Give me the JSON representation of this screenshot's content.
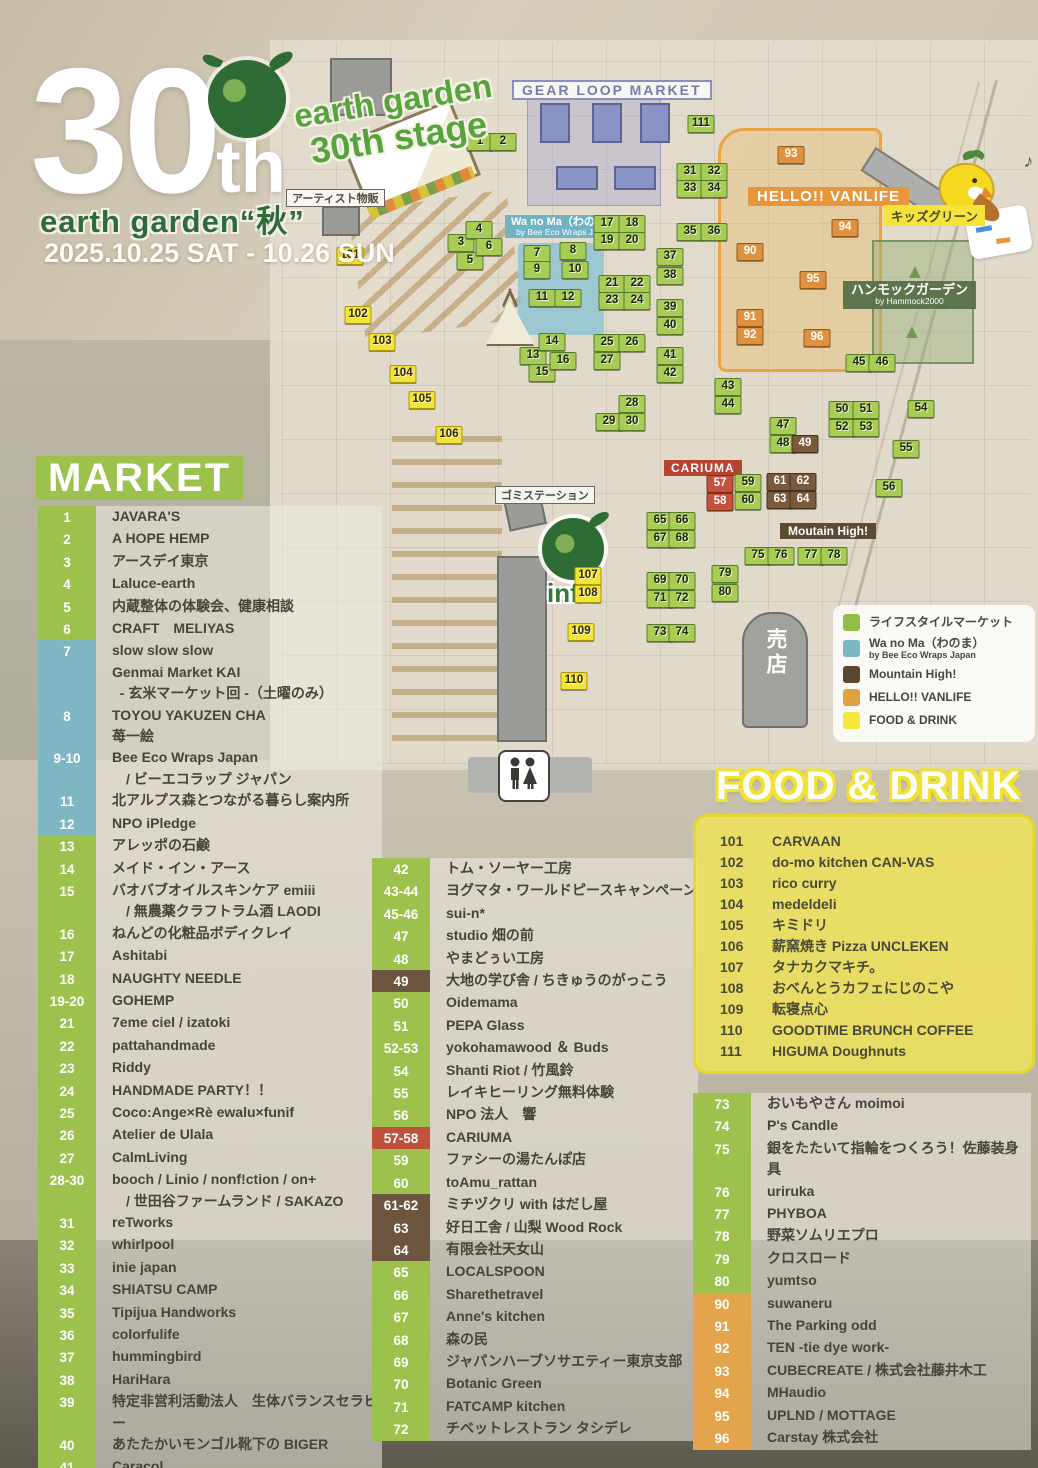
{
  "header": {
    "number": "30",
    "suffix": "th",
    "event_title": "earth garden“秋”",
    "dates": "2025.10.25 SAT - 10.26 SUN",
    "stage_line1": "earth garden",
    "stage_line2": "30th stage"
  },
  "map": {
    "labels": {
      "gear_loop": "GEAR LOOP MARKET",
      "artist_goods": "アーティスト物販",
      "wanoma_title": "Wa no Ma（わのま）",
      "wanoma_sub": "by Bee Eco Wraps Japan",
      "vanlife": "HELLO!! VANLIFE",
      "kids_green": "キッズグリーン",
      "hammock_title": "ハンモックガーデン",
      "hammock_sub": "by Hammock2000",
      "cariuma": "CARIUMA",
      "trash_station": "ゴミステーション",
      "mountain_high": "Moutain High!",
      "info": "info",
      "shop": "売店",
      "note": "♪"
    },
    "markers": [
      {
        "n": "1",
        "x": 480,
        "y": 142,
        "c": "g"
      },
      {
        "n": "2",
        "x": 503,
        "y": 142,
        "c": "g"
      },
      {
        "n": "3",
        "x": 461,
        "y": 243,
        "c": "g"
      },
      {
        "n": "4",
        "x": 479,
        "y": 230,
        "c": "g"
      },
      {
        "n": "5",
        "x": 470,
        "y": 261,
        "c": "g"
      },
      {
        "n": "6",
        "x": 489,
        "y": 247,
        "c": "g"
      },
      {
        "n": "7",
        "x": 537,
        "y": 254,
        "c": "g"
      },
      {
        "n": "8",
        "x": 573,
        "y": 251,
        "c": "g"
      },
      {
        "n": "9",
        "x": 537,
        "y": 270,
        "c": "g"
      },
      {
        "n": "10",
        "x": 575,
        "y": 270,
        "c": "g"
      },
      {
        "n": "11",
        "x": 542,
        "y": 298,
        "c": "g"
      },
      {
        "n": "12",
        "x": 568,
        "y": 298,
        "c": "g"
      },
      {
        "n": "13",
        "x": 533,
        "y": 356,
        "c": "g"
      },
      {
        "n": "14",
        "x": 552,
        "y": 342,
        "c": "g"
      },
      {
        "n": "15",
        "x": 542,
        "y": 373,
        "c": "g"
      },
      {
        "n": "16",
        "x": 563,
        "y": 361,
        "c": "g"
      },
      {
        "n": "17",
        "x": 607,
        "y": 224,
        "c": "g"
      },
      {
        "n": "18",
        "x": 632,
        "y": 224,
        "c": "g"
      },
      {
        "n": "19",
        "x": 607,
        "y": 241,
        "c": "g"
      },
      {
        "n": "20",
        "x": 632,
        "y": 241,
        "c": "g"
      },
      {
        "n": "21",
        "x": 612,
        "y": 284,
        "c": "g"
      },
      {
        "n": "22",
        "x": 637,
        "y": 284,
        "c": "g"
      },
      {
        "n": "23",
        "x": 612,
        "y": 301,
        "c": "g"
      },
      {
        "n": "24",
        "x": 637,
        "y": 301,
        "c": "g"
      },
      {
        "n": "25",
        "x": 607,
        "y": 343,
        "c": "g"
      },
      {
        "n": "26",
        "x": 632,
        "y": 343,
        "c": "g"
      },
      {
        "n": "27",
        "x": 607,
        "y": 361,
        "c": "g"
      },
      {
        "n": "28",
        "x": 632,
        "y": 404,
        "c": "g"
      },
      {
        "n": "29",
        "x": 609,
        "y": 422,
        "c": "g"
      },
      {
        "n": "30",
        "x": 632,
        "y": 422,
        "c": "g"
      },
      {
        "n": "31",
        "x": 690,
        "y": 172,
        "c": "g"
      },
      {
        "n": "32",
        "x": 714,
        "y": 172,
        "c": "g"
      },
      {
        "n": "33",
        "x": 690,
        "y": 189,
        "c": "g"
      },
      {
        "n": "34",
        "x": 714,
        "y": 189,
        "c": "g"
      },
      {
        "n": "35",
        "x": 690,
        "y": 232,
        "c": "g"
      },
      {
        "n": "36",
        "x": 714,
        "y": 232,
        "c": "g"
      },
      {
        "n": "37",
        "x": 670,
        "y": 257,
        "c": "g"
      },
      {
        "n": "38",
        "x": 670,
        "y": 276,
        "c": "g"
      },
      {
        "n": "39",
        "x": 670,
        "y": 308,
        "c": "g"
      },
      {
        "n": "40",
        "x": 670,
        "y": 326,
        "c": "g"
      },
      {
        "n": "41",
        "x": 670,
        "y": 356,
        "c": "g"
      },
      {
        "n": "42",
        "x": 670,
        "y": 374,
        "c": "g"
      },
      {
        "n": "43",
        "x": 728,
        "y": 387,
        "c": "g"
      },
      {
        "n": "44",
        "x": 728,
        "y": 405,
        "c": "g"
      },
      {
        "n": "45",
        "x": 859,
        "y": 363,
        "c": "g"
      },
      {
        "n": "46",
        "x": 882,
        "y": 363,
        "c": "g"
      },
      {
        "n": "47",
        "x": 783,
        "y": 426,
        "c": "g"
      },
      {
        "n": "48",
        "x": 783,
        "y": 444,
        "c": "g"
      },
      {
        "n": "49",
        "x": 805,
        "y": 444,
        "c": "b"
      },
      {
        "n": "50",
        "x": 842,
        "y": 410,
        "c": "g"
      },
      {
        "n": "51",
        "x": 866,
        "y": 410,
        "c": "g"
      },
      {
        "n": "52",
        "x": 842,
        "y": 428,
        "c": "g"
      },
      {
        "n": "53",
        "x": 866,
        "y": 428,
        "c": "g"
      },
      {
        "n": "54",
        "x": 921,
        "y": 409,
        "c": "g"
      },
      {
        "n": "55",
        "x": 906,
        "y": 449,
        "c": "g"
      },
      {
        "n": "56",
        "x": 889,
        "y": 488,
        "c": "g"
      },
      {
        "n": "57",
        "x": 720,
        "y": 484,
        "c": "r"
      },
      {
        "n": "58",
        "x": 720,
        "y": 502,
        "c": "r"
      },
      {
        "n": "59",
        "x": 748,
        "y": 483,
        "c": "g"
      },
      {
        "n": "60",
        "x": 748,
        "y": 501,
        "c": "g"
      },
      {
        "n": "61",
        "x": 780,
        "y": 482,
        "c": "b"
      },
      {
        "n": "62",
        "x": 803,
        "y": 482,
        "c": "b"
      },
      {
        "n": "63",
        "x": 780,
        "y": 500,
        "c": "b"
      },
      {
        "n": "64",
        "x": 803,
        "y": 500,
        "c": "b"
      },
      {
        "n": "65",
        "x": 660,
        "y": 521,
        "c": "g"
      },
      {
        "n": "66",
        "x": 682,
        "y": 521,
        "c": "g"
      },
      {
        "n": "67",
        "x": 660,
        "y": 539,
        "c": "g"
      },
      {
        "n": "68",
        "x": 682,
        "y": 539,
        "c": "g"
      },
      {
        "n": "69",
        "x": 660,
        "y": 581,
        "c": "g"
      },
      {
        "n": "70",
        "x": 682,
        "y": 581,
        "c": "g"
      },
      {
        "n": "71",
        "x": 660,
        "y": 599,
        "c": "g"
      },
      {
        "n": "72",
        "x": 682,
        "y": 599,
        "c": "g"
      },
      {
        "n": "73",
        "x": 660,
        "y": 633,
        "c": "g"
      },
      {
        "n": "74",
        "x": 682,
        "y": 633,
        "c": "g"
      },
      {
        "n": "75",
        "x": 758,
        "y": 556,
        "c": "g"
      },
      {
        "n": "76",
        "x": 781,
        "y": 556,
        "c": "g"
      },
      {
        "n": "77",
        "x": 811,
        "y": 556,
        "c": "g"
      },
      {
        "n": "78",
        "x": 834,
        "y": 556,
        "c": "g"
      },
      {
        "n": "79",
        "x": 725,
        "y": 574,
        "c": "g"
      },
      {
        "n": "80",
        "x": 725,
        "y": 593,
        "c": "g"
      },
      {
        "n": "90",
        "x": 750,
        "y": 252,
        "c": "o"
      },
      {
        "n": "91",
        "x": 750,
        "y": 318,
        "c": "o"
      },
      {
        "n": "92",
        "x": 750,
        "y": 336,
        "c": "o"
      },
      {
        "n": "93",
        "x": 791,
        "y": 155,
        "c": "o"
      },
      {
        "n": "94",
        "x": 845,
        "y": 228,
        "c": "o"
      },
      {
        "n": "95",
        "x": 813,
        "y": 280,
        "c": "o"
      },
      {
        "n": "96",
        "x": 817,
        "y": 338,
        "c": "o"
      },
      {
        "n": "101",
        "x": 350,
        "y": 256,
        "c": "y"
      },
      {
        "n": "102",
        "x": 358,
        "y": 315,
        "c": "y"
      },
      {
        "n": "103",
        "x": 382,
        "y": 342,
        "c": "y"
      },
      {
        "n": "104",
        "x": 403,
        "y": 374,
        "c": "y"
      },
      {
        "n": "105",
        "x": 422,
        "y": 400,
        "c": "y"
      },
      {
        "n": "106",
        "x": 449,
        "y": 435,
        "c": "y"
      },
      {
        "n": "107",
        "x": 588,
        "y": 576,
        "c": "y"
      },
      {
        "n": "108",
        "x": 588,
        "y": 594,
        "c": "y"
      },
      {
        "n": "109",
        "x": 581,
        "y": 632,
        "c": "y"
      },
      {
        "n": "110",
        "x": 574,
        "y": 681,
        "c": "y"
      },
      {
        "n": "111",
        "x": 701,
        "y": 124,
        "c": "g"
      }
    ]
  },
  "legend": {
    "items": [
      {
        "label": "ライフスタイルマーケット",
        "sub": "",
        "color": "#8fc045"
      },
      {
        "label": "Wa no Ma（わのま）",
        "sub": "by Bee Eco Wraps Japan",
        "color": "#7ab8c4"
      },
      {
        "label": "Mountain High!",
        "sub": "",
        "color": "#5d4630"
      },
      {
        "label": "HELLO!! VANLIFE",
        "sub": "",
        "color": "#e0a13e"
      },
      {
        "label": "FOOD & DRINK",
        "sub": "",
        "color": "#f5e73c"
      }
    ]
  },
  "market": {
    "title": "MARKET",
    "col1": [
      {
        "no": "1",
        "c": "g",
        "lines": [
          "JAVARA'S"
        ]
      },
      {
        "no": "2",
        "c": "g",
        "lines": [
          "A HOPE HEMP"
        ]
      },
      {
        "no": "3",
        "c": "g",
        "lines": [
          "アースデイ東京"
        ]
      },
      {
        "no": "4",
        "c": "g",
        "lines": [
          "Laluce-earth"
        ]
      },
      {
        "no": "5",
        "c": "g",
        "lines": [
          "内蔵整体の体験会、健康相談"
        ]
      },
      {
        "no": "6",
        "c": "g",
        "lines": [
          "CRAFT　MELIYAS"
        ]
      },
      {
        "no": "7",
        "c": "t",
        "lines": [
          "slow slow slow",
          "Genmai Market KAI",
          "  - 玄米マーケット回 -（土曜のみ）"
        ]
      },
      {
        "no": "8",
        "c": "t",
        "lines": [
          "TOYOU YAKUZEN CHA",
          "苺一絵"
        ]
      },
      {
        "no": "9-10",
        "c": "t",
        "lines": [
          "Bee Eco Wraps Japan",
          "　/ ビーエコラップ ジャパン"
        ]
      },
      {
        "no": "11",
        "c": "t",
        "lines": [
          "北アルプス森とつながる暮らし案内所"
        ]
      },
      {
        "no": "12",
        "c": "t",
        "lines": [
          "NPO iPledge"
        ]
      },
      {
        "no": "13",
        "c": "g",
        "lines": [
          "アレッポの石鹸"
        ]
      },
      {
        "no": "14",
        "c": "g",
        "lines": [
          "メイド・イン・アース"
        ]
      },
      {
        "no": "15",
        "c": "g",
        "lines": [
          "バオバブオイルスキンケア emiii",
          "　/ 無農薬クラフトラム酒 LAODI"
        ]
      },
      {
        "no": "16",
        "c": "g",
        "lines": [
          "ねんどの化粧品ボディクレイ"
        ]
      },
      {
        "no": "17",
        "c": "g",
        "lines": [
          "Ashitabi"
        ]
      },
      {
        "no": "18",
        "c": "g",
        "lines": [
          "NAUGHTY NEEDLE"
        ]
      },
      {
        "no": "19-20",
        "c": "g",
        "lines": [
          "GOHEMP"
        ]
      },
      {
        "no": "21",
        "c": "g",
        "lines": [
          "7eme ciel / izatoki"
        ]
      },
      {
        "no": "22",
        "c": "g",
        "lines": [
          "pattahandmade"
        ]
      },
      {
        "no": "23",
        "c": "g",
        "lines": [
          "Riddy"
        ]
      },
      {
        "no": "24",
        "c": "g",
        "lines": [
          "HANDMADE PARTY！！"
        ]
      },
      {
        "no": "25",
        "c": "g",
        "lines": [
          "Coco:Ange×Rè ewalu×funif"
        ]
      },
      {
        "no": "26",
        "c": "g",
        "lines": [
          "Atelier de Ulala"
        ]
      },
      {
        "no": "27",
        "c": "g",
        "lines": [
          "CalmLiving"
        ]
      },
      {
        "no": "28-30",
        "c": "g",
        "lines": [
          "booch / Linio / nonf!ction / on+",
          "　/ 世田谷ファームランド / SAKAZO"
        ]
      },
      {
        "no": "31",
        "c": "g",
        "lines": [
          "reTworks"
        ]
      },
      {
        "no": "32",
        "c": "g",
        "lines": [
          "whirlpool"
        ]
      },
      {
        "no": "33",
        "c": "g",
        "lines": [
          "inie japan"
        ]
      },
      {
        "no": "34",
        "c": "g",
        "lines": [
          "SHIATSU CAMP"
        ]
      },
      {
        "no": "35",
        "c": "g",
        "lines": [
          "Tipijua Handworks"
        ]
      },
      {
        "no": "36",
        "c": "g",
        "lines": [
          "colorfulife"
        ]
      },
      {
        "no": "37",
        "c": "g",
        "lines": [
          "hummingbird"
        ]
      },
      {
        "no": "38",
        "c": "g",
        "lines": [
          "HariHara"
        ]
      },
      {
        "no": "39",
        "c": "g",
        "lines": [
          "特定非営利活動法人　生体バランスセラピー"
        ]
      },
      {
        "no": "40",
        "c": "g",
        "lines": [
          "あたたかいモンゴル靴下の BIGER"
        ]
      },
      {
        "no": "41",
        "c": "g",
        "lines": [
          "Caracol"
        ]
      }
    ],
    "col2": [
      {
        "no": "42",
        "c": "g",
        "lines": [
          "トム・ソーヤー工房"
        ]
      },
      {
        "no": "43-44",
        "c": "g",
        "lines": [
          "ヨグマタ・ワールドピースキャンペーン"
        ]
      },
      {
        "no": "45-46",
        "c": "g",
        "lines": [
          "sui-n*"
        ]
      },
      {
        "no": "47",
        "c": "g",
        "lines": [
          "studio 畑の前"
        ]
      },
      {
        "no": "48",
        "c": "g",
        "lines": [
          "やまどぅい工房"
        ]
      },
      {
        "no": "49",
        "c": "b",
        "lines": [
          "大地の学び舎 / ちきゅうのがっこう"
        ]
      },
      {
        "no": "50",
        "c": "g",
        "lines": [
          "Oidemama"
        ]
      },
      {
        "no": "51",
        "c": "g",
        "lines": [
          "PEPA Glass"
        ]
      },
      {
        "no": "52-53",
        "c": "g",
        "lines": [
          "yokohamawood ＆ Buds"
        ]
      },
      {
        "no": "54",
        "c": "g",
        "lines": [
          "Shanti Riot / 竹風鈴"
        ]
      },
      {
        "no": "55",
        "c": "g",
        "lines": [
          "レイキヒーリング無料体験"
        ]
      },
      {
        "no": "56",
        "c": "g",
        "lines": [
          "NPO 法人　響"
        ]
      },
      {
        "no": "57-58",
        "c": "r",
        "lines": [
          "CARIUMA"
        ]
      },
      {
        "no": "59",
        "c": "g",
        "lines": [
          "ファシーの湯たんぽ店"
        ]
      },
      {
        "no": "60",
        "c": "g",
        "lines": [
          "toAmu_rattan"
        ]
      },
      {
        "no": "61-62",
        "c": "b",
        "lines": [
          "ミチヅクリ with はだし屋"
        ]
      },
      {
        "no": "63",
        "c": "b",
        "lines": [
          "好日工舎 / 山梨 Wood Rock"
        ]
      },
      {
        "no": "64",
        "c": "b",
        "lines": [
          "有限会社天女山"
        ]
      },
      {
        "no": "65",
        "c": "g",
        "lines": [
          "LOCALSPOON"
        ]
      },
      {
        "no": "66",
        "c": "g",
        "lines": [
          "Sharethetravel"
        ]
      },
      {
        "no": "67",
        "c": "g",
        "lines": [
          "Anne's kitchen"
        ]
      },
      {
        "no": "68",
        "c": "g",
        "lines": [
          "森の民"
        ]
      },
      {
        "no": "69",
        "c": "g",
        "lines": [
          "ジャパンハーブソサエティー東京支部"
        ]
      },
      {
        "no": "70",
        "c": "g",
        "lines": [
          "Botanic Green"
        ]
      },
      {
        "no": "71",
        "c": "g",
        "lines": [
          "FATCAMP kitchen"
        ]
      },
      {
        "no": "72",
        "c": "g",
        "lines": [
          "チベットレストラン タシデレ"
        ]
      }
    ],
    "col3": [
      {
        "no": "73",
        "c": "g",
        "lines": [
          "おいもやさん moimoi"
        ]
      },
      {
        "no": "74",
        "c": "g",
        "lines": [
          "P's Candle"
        ]
      },
      {
        "no": "75",
        "c": "g",
        "lines": [
          "銀をたたいて指輪をつくろう！佐藤装身具"
        ]
      },
      {
        "no": "76",
        "c": "g",
        "lines": [
          "uriruka"
        ]
      },
      {
        "no": "77",
        "c": "g",
        "lines": [
          "PHYBOA"
        ]
      },
      {
        "no": "78",
        "c": "g",
        "lines": [
          "野菜ソムリエプロ"
        ]
      },
      {
        "no": "79",
        "c": "g",
        "lines": [
          "クロスロード"
        ]
      },
      {
        "no": "80",
        "c": "g",
        "lines": [
          "yumtso"
        ]
      },
      {
        "no": "90",
        "c": "o",
        "lines": [
          "suwaneru"
        ]
      },
      {
        "no": "91",
        "c": "o",
        "lines": [
          "The Parking odd"
        ]
      },
      {
        "no": "92",
        "c": "o",
        "lines": [
          "TEN -tie dye work-"
        ]
      },
      {
        "no": "93",
        "c": "o",
        "lines": [
          "CUBECREATE / 株式会社藤井木工"
        ]
      },
      {
        "no": "94",
        "c": "o",
        "lines": [
          "MHaudio"
        ]
      },
      {
        "no": "95",
        "c": "o",
        "lines": [
          "UPLND / MOTTAGE"
        ]
      },
      {
        "no": "96",
        "c": "o",
        "lines": [
          "Carstay 株式会社"
        ]
      }
    ]
  },
  "food": {
    "title": "FOOD & DRINK",
    "items": [
      {
        "no": "101",
        "name": "CARVAAN"
      },
      {
        "no": "102",
        "name": "do-mo kitchen CAN-VAS"
      },
      {
        "no": "103",
        "name": "rico curry"
      },
      {
        "no": "104",
        "name": "medeldeli"
      },
      {
        "no": "105",
        "name": "キミドリ"
      },
      {
        "no": "106",
        "name": "薪窯焼き Pizza UNCLEKEN"
      },
      {
        "no": "107",
        "name": "タナカクマキチ。"
      },
      {
        "no": "108",
        "name": "おべんとうカフェにじのこや"
      },
      {
        "no": "109",
        "name": "転寝点心"
      },
      {
        "no": "110",
        "name": "GOODTIME BRUNCH COFFEE"
      },
      {
        "no": "111",
        "name": "HIGUMA Doughnuts"
      }
    ]
  }
}
